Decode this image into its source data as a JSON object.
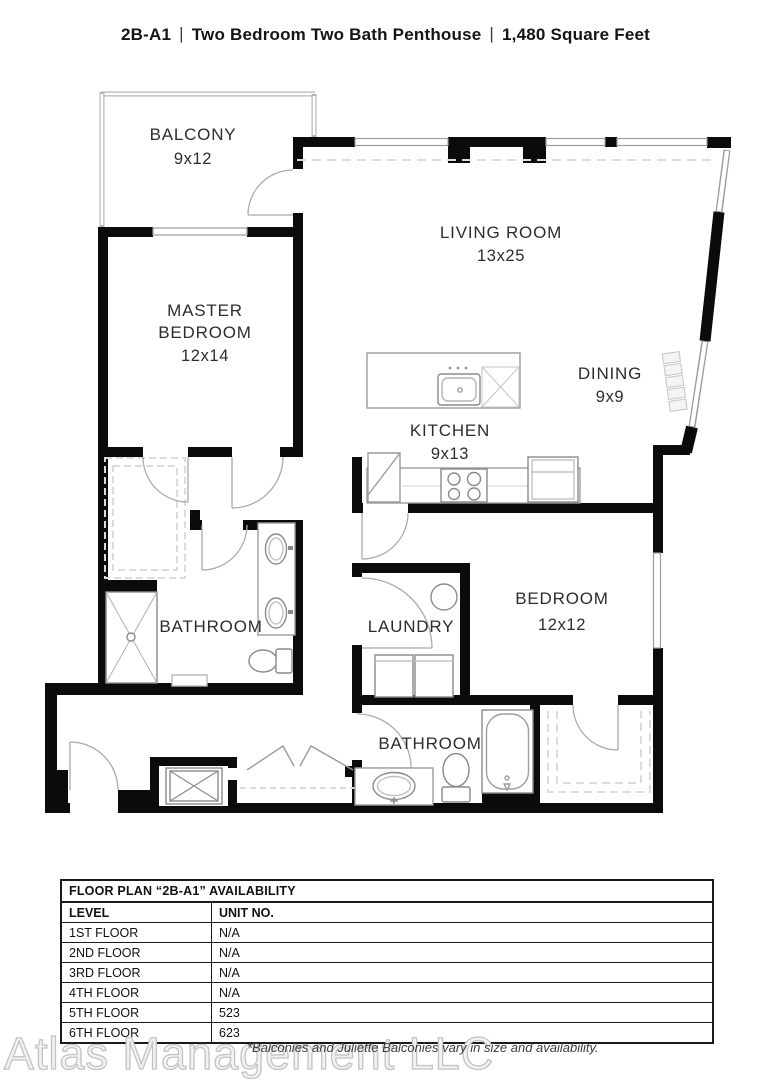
{
  "title": {
    "parts": [
      "2B-A1",
      "Two Bedroom Two Bath Penthouse",
      "1,480 Square Feet"
    ],
    "separator": "|"
  },
  "rooms": {
    "balcony": {
      "name": "BALCONY",
      "dims": "9x12"
    },
    "living": {
      "name": "LIVING ROOM",
      "dims": "13x25"
    },
    "master": {
      "name1": "MASTER",
      "name2": "BEDROOM",
      "dims": "12x14"
    },
    "dining": {
      "name": "DINING",
      "dims": "9x9"
    },
    "kitchen": {
      "name": "KITCHEN",
      "dims": "9x13"
    },
    "master_bath": {
      "name": "BATHROOM"
    },
    "laundry": {
      "name": "LAUNDRY"
    },
    "bedroom2": {
      "name": "BEDROOM",
      "dims": "12x12"
    },
    "bath2": {
      "name": "BATHROOM"
    }
  },
  "availability": {
    "title": "FLOOR PLAN “2B-A1” AVAILABILITY",
    "columns": [
      "LEVEL",
      "UNIT NO."
    ],
    "rows": [
      [
        "1ST FLOOR",
        "N/A"
      ],
      [
        "2ND FLOOR",
        "N/A"
      ],
      [
        "3RD FLOOR",
        "N/A"
      ],
      [
        "4TH FLOOR",
        "N/A"
      ],
      [
        "5TH FLOOR",
        "523"
      ],
      [
        "6TH FLOOR",
        "623"
      ]
    ]
  },
  "footer": {
    "watermark": "Atlas Management LLC",
    "disclaimer": "*Balconies and Juliette Balconies vary in size and availability."
  },
  "colors": {
    "wall": "#0b0b0b",
    "window": "#9c9c9c",
    "door_arc": "#ababab",
    "fixture": "#8a8a8a",
    "dashed": "#dcdcdc",
    "label_text": "#2d2d2d",
    "watermark": "#c3c3c3"
  }
}
